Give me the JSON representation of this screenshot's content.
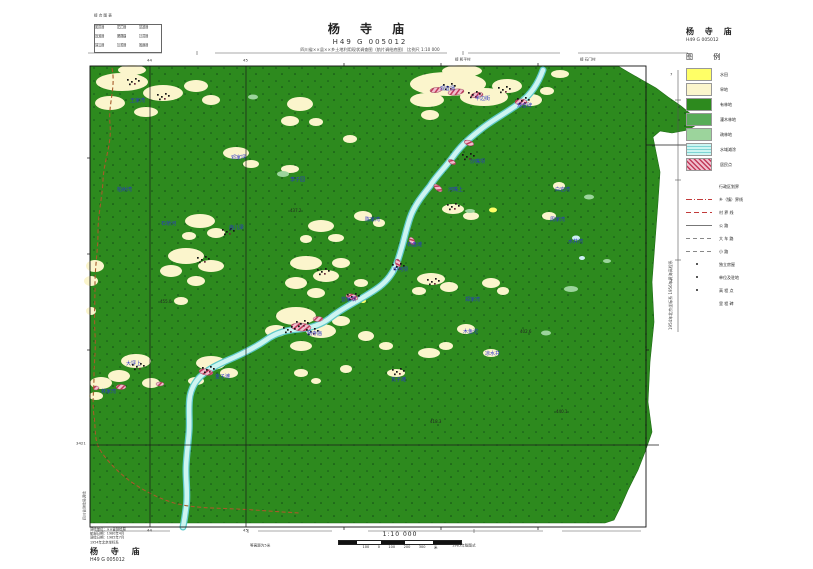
{
  "sheet": {
    "title": "杨 寺 庙",
    "sheet_no": "H49 G 005012",
    "subtitle": "四川省××县××乡土地利用现状调查图（航片调绘底图）  比例尺 1:10 000"
  },
  "index_map": {
    "caption": "接 合 图 表",
    "cells": [
      "和平村",
      "石门村",
      "高桥村",
      "龙塘村",
      "杨寺庙",
      "小河村",
      "青山村",
      "沙坝村",
      "柏林村"
    ]
  },
  "legend": {
    "title": "杨 寺 庙",
    "sheet_no": "H49 G 005012",
    "header": "图  例",
    "fills": [
      {
        "label": "水田",
        "color": "#FFFF66"
      },
      {
        "label": "旱地",
        "color": "#FBF5CC"
      },
      {
        "label": "有林地",
        "color": "#2D8A1E"
      },
      {
        "label": "灌木林地",
        "color": "#58AC58"
      },
      {
        "label": "疏林地",
        "color": "#9CD49C"
      },
      {
        "label": "水域滩涂",
        "color": "#CDF5F1"
      },
      {
        "label": "居民点",
        "color": "#E8A7BD"
      }
    ],
    "symbols": [
      {
        "label": "行政区划界"
      },
      {
        "label": "乡（镇）界线"
      },
      {
        "label": "村 界 线"
      },
      {
        "label": "公 路"
      },
      {
        "label": "大 车 路"
      },
      {
        "label": "小 路"
      },
      {
        "label": "独立房屋"
      },
      {
        "label": "单位及驻地"
      },
      {
        "label": "高 程 点"
      },
      {
        "label": "里 程 碑"
      }
    ]
  },
  "block": {
    "lines": [
      "调绘单位：××省测绘局",
      "航摄日期：1980年4月",
      "调绘日期：1985年7月",
      "1954年北京坐标系"
    ],
    "title": "杨 寺 庙",
    "sheet_no": "H49 G 005012"
  },
  "scale": {
    "label": "1:10 000",
    "marks": [
      "100",
      "0",
      "100",
      "200",
      "300"
    ],
    "unit": "米",
    "contour_note": "等高距为5米",
    "edition_note": "1985年版图式"
  },
  "margin": {
    "top_note_1": "接 和平村",
    "top_note_2": "接 石门村",
    "right_note": "1954年北京坐标系  1956年黄海高程系",
    "left_note": "四川省测绘局调绘",
    "tick_7": "7",
    "tick_3": "3"
  },
  "grid": {
    "v1": "44",
    "v2": "45",
    "h1": "3421"
  },
  "colors": {
    "forest": "#2D8A1E",
    "farmland": "#FBF5CC",
    "paddy": "#FFFF66",
    "shrub": "#58AC58",
    "sparse": "#9CD49C",
    "river_fill": "#CDF5F1",
    "river_edge": "#5FC9C9",
    "settlement": "#E8A7BD",
    "settlement_hatch": "#C23A5A",
    "boundary": "#A65A2A",
    "label_blue": "#2A35C8",
    "grid_line": "#1A1A1A"
  },
  "map": {
    "labels": [
      {
        "t": "王家湾"
      },
      {
        "t": "柏树湾"
      },
      {
        "t": "邓家坪"
      },
      {
        "t": "李子园"
      },
      {
        "t": "石桥河"
      },
      {
        "t": "庙儿梁"
      },
      {
        "t": "陈家湾"
      },
      {
        "t": "观音场"
      },
      {
        "t": "半边街"
      },
      {
        "t": "观音碑"
      },
      {
        "t": "沙嘴坝"
      },
      {
        "t": "河嘴上"
      },
      {
        "t": "白岩湾"
      },
      {
        "t": "周家湾"
      },
      {
        "t": "石盘滩"
      },
      {
        "t": "中河坝"
      },
      {
        "t": "曾家坝"
      },
      {
        "t": "杨寺庙"
      },
      {
        "t": "金子滩"
      },
      {
        "t": "大坪上"
      },
      {
        "t": "林家湾"
      },
      {
        "t": "瓦子滩"
      },
      {
        "t": "木鱼沱"
      },
      {
        "t": "凉水井"
      },
      {
        "t": "郑家湾"
      },
      {
        "t": "水井湾"
      }
    ],
    "elevations": [
      {
        "t": "437.2"
      },
      {
        "t": "402.6"
      },
      {
        "t": "455.0"
      },
      {
        "t": "418.3"
      },
      {
        "t": "440.1"
      }
    ]
  }
}
